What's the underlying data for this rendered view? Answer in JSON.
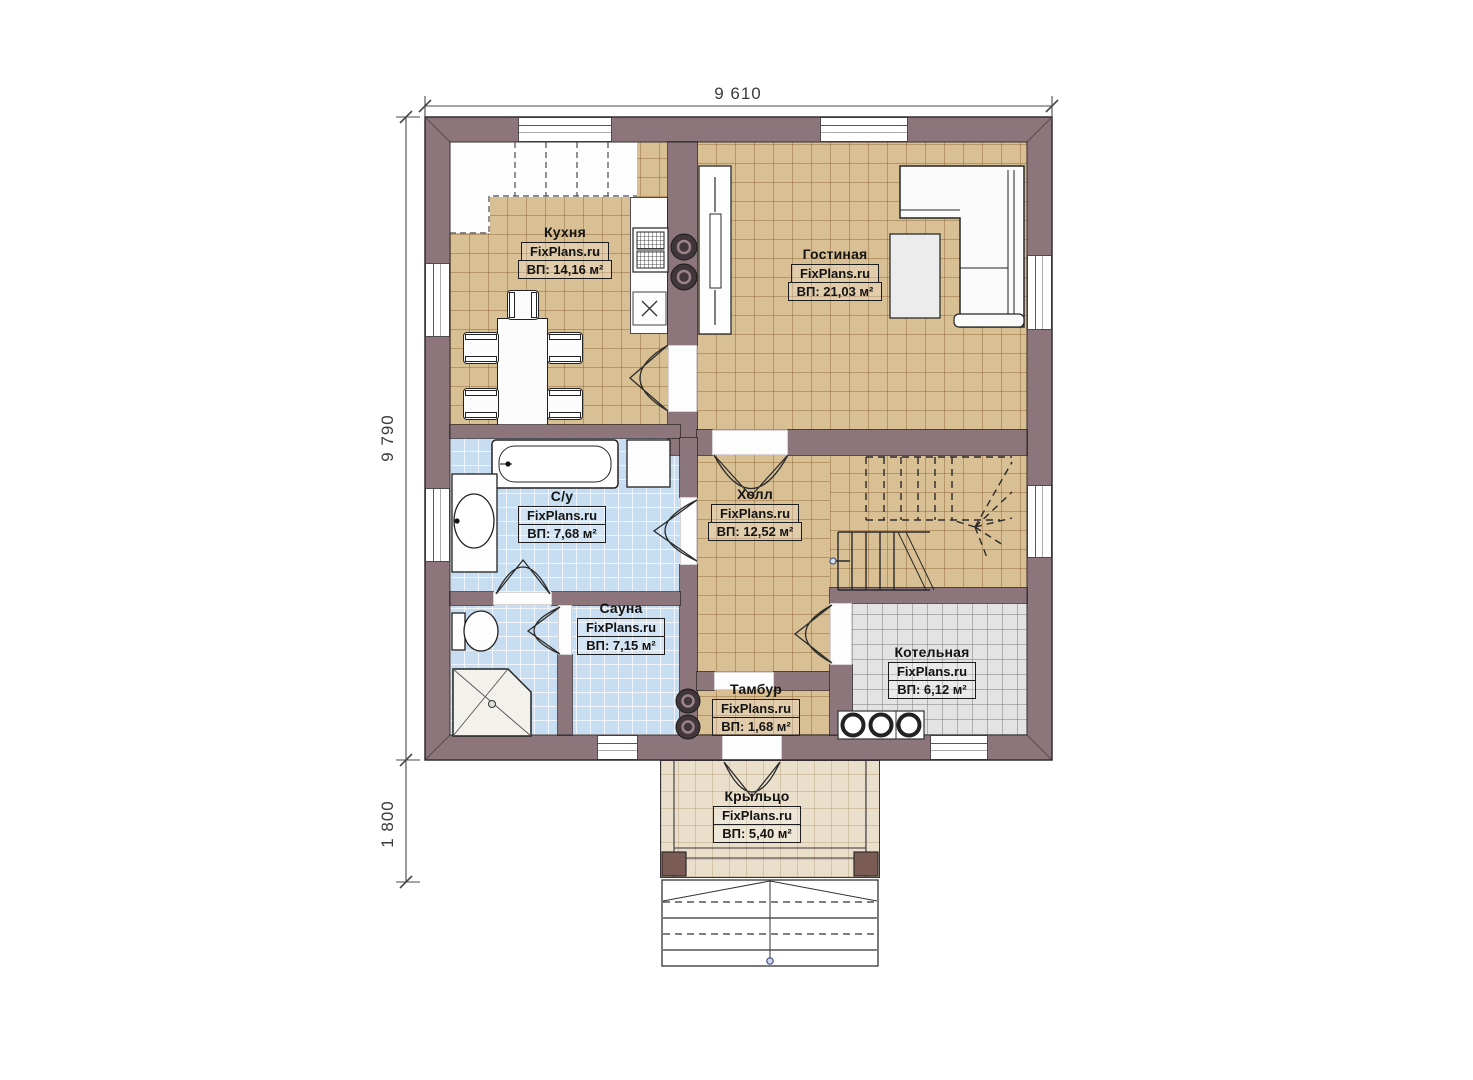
{
  "plan_title": "floor-plan",
  "dimensions": {
    "top_width": "9 610",
    "left_height": "9 790",
    "porch_depth": "1 800"
  },
  "rooms": [
    {
      "id": "kitchen",
      "name": "Кухня",
      "brand": "FixPlans.ru",
      "area": "ВП: 14,16 м²"
    },
    {
      "id": "living",
      "name": "Гостиная",
      "brand": "FixPlans.ru",
      "area": "ВП: 21,03 м²"
    },
    {
      "id": "bathroom",
      "name": "С/у",
      "brand": "FixPlans.ru",
      "area": "ВП: 7,68 м²"
    },
    {
      "id": "hall",
      "name": "Холл",
      "brand": "FixPlans.ru",
      "area": "ВП: 12,52 м²"
    },
    {
      "id": "sauna",
      "name": "Сауна",
      "brand": "FixPlans.ru",
      "area": "ВП: 7,15 м²"
    },
    {
      "id": "tambour",
      "name": "Тамбур",
      "brand": "FixPlans.ru",
      "area": "ВП: 1,68 м²"
    },
    {
      "id": "boiler",
      "name": "Котельная",
      "brand": "FixPlans.ru",
      "area": "ВП: 6,12 м²"
    },
    {
      "id": "porch",
      "name": "Крыльцо",
      "brand": "FixPlans.ru",
      "area": "ВП: 5,40 м²"
    }
  ],
  "labels": {
    "washing_machine": "Ст.М."
  },
  "colors": {
    "wall": "#8d767b",
    "floor_tan": "#d9bf94",
    "floor_blue": "#c7ddf2",
    "floor_gray": "#e3e3e3",
    "floor_porch": "#e9dfcb"
  }
}
